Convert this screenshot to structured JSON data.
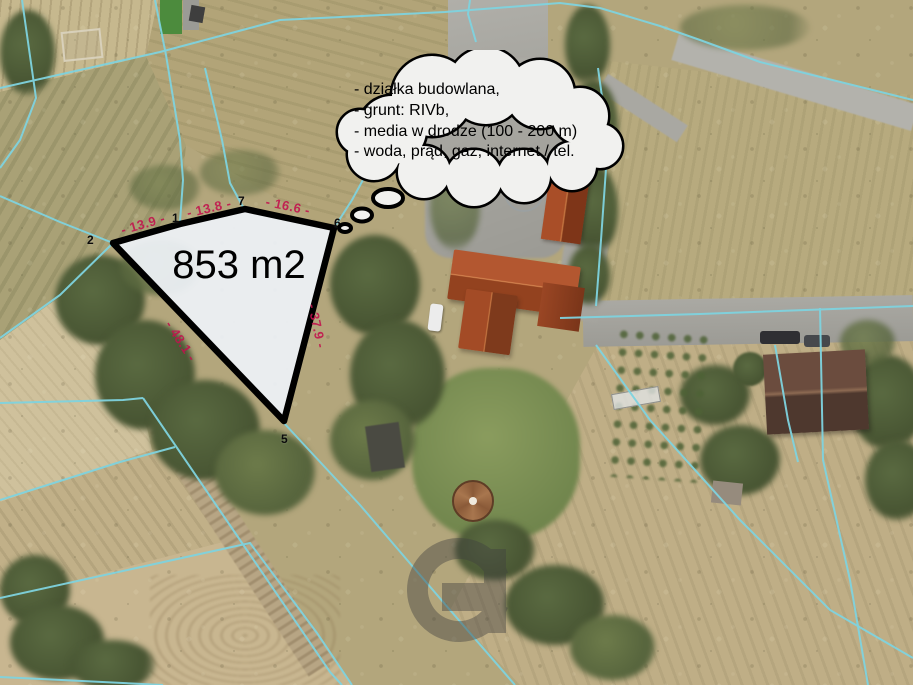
{
  "scene": {
    "type": "aerial-parcel-map",
    "description_visible_text_only": true
  },
  "plot": {
    "area_label": "853 m2",
    "point_labels": [
      "2",
      "1",
      "7",
      "6",
      "5"
    ],
    "edge_measurements": [
      "- 13.9 -",
      "- 13.8 -",
      "- 16.6 -",
      "- 37.9 -",
      "- 48.1 -"
    ]
  },
  "callout": {
    "lines": [
      "- działka budowlana,",
      "- grunt: RIVb,",
      "- media w drodze (100 - 200 m)",
      "- woda, prąd, gaz, internet / tel."
    ]
  },
  "watermark": {
    "icon": "g-ring-logo"
  },
  "colors": {
    "parcel_boundary": "#7fd3df",
    "plot_fill": "#eef2f7",
    "plot_outline": "#000000",
    "measurement_text": "#c2124d",
    "cloud_fill": "#f1f1ef"
  }
}
